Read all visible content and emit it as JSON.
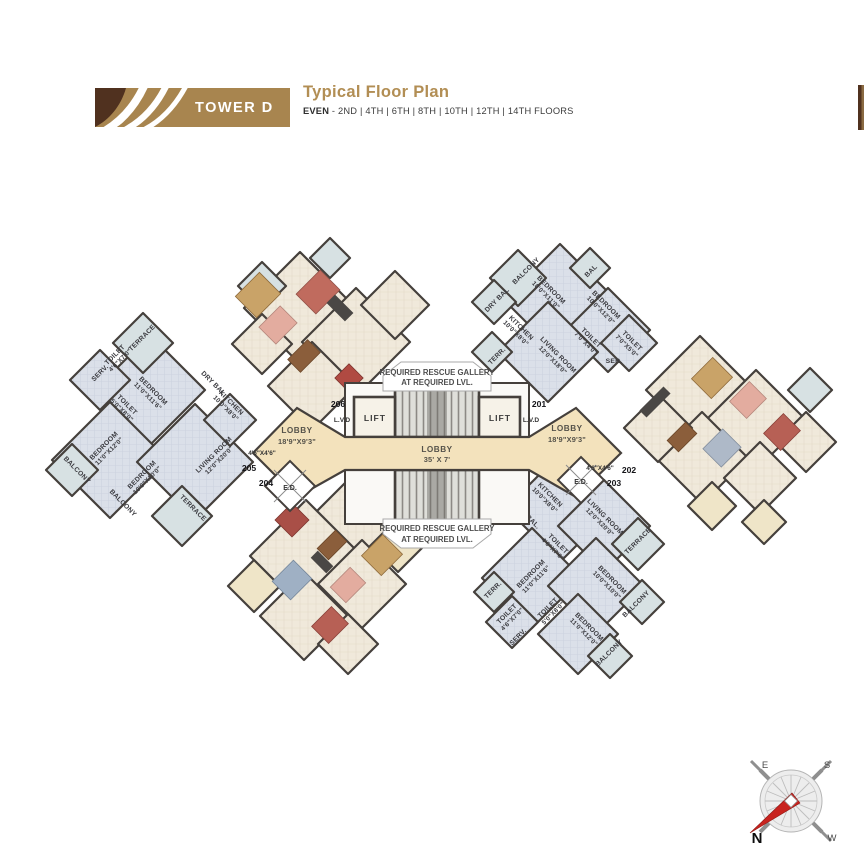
{
  "header": {
    "tower_label": "TOWER D",
    "title": "Typical Floor Plan",
    "floors_prefix": "EVEN",
    "floors_rest": " - 2ND | 4TH | 6TH | 8TH | 10TH | 12TH | 14TH FLOORS",
    "banner_color": "#A8854F",
    "banner_dark": "#50311F",
    "accent_color": "#B28E54"
  },
  "core": {
    "rescue_top_1": "REQUIRED RESCUE GALLERY",
    "rescue_top_2": "AT REQUIRED LVL.",
    "rescue_bottom_1": "REQUIRED RESCUE GALLERY",
    "rescue_bottom_2": "AT REQUIRED LVL.",
    "lobby_main": {
      "label": "LOBBY",
      "size": "35' X 7'"
    },
    "lobby_left": {
      "label": "LOBBY",
      "size": "18'9\"X9'3\""
    },
    "lobby_right": {
      "label": "LOBBY",
      "size": "18'9\"X9'3\""
    },
    "lift_left": "LIFT",
    "lift_right": "LIFT",
    "lvd_left": "L.V.D",
    "lvd_right": "L.V.D",
    "ed_left": {
      "label": "E.D.",
      "size": "4'6\"X4'6\""
    },
    "ed_right": {
      "label": "E.D.",
      "size": "4'6\"X4'6\""
    }
  },
  "unit_numbers": {
    "u201": "201",
    "u202": "202",
    "u203": "203",
    "u204": "204",
    "u205": "205",
    "u206": "206"
  },
  "unit_205": {
    "terrace_top": {
      "label": "TERRACE"
    },
    "toilet_a": {
      "label": "TOILET",
      "size": "4'6\"X7'0\""
    },
    "serv": {
      "label": "SERV."
    },
    "bedroom_a": {
      "label": "BEDROOM",
      "size": "11'0\"X11'6\""
    },
    "toilet_b": {
      "label": "TOILET",
      "size": "5'0\"X8'0\""
    },
    "dry_bal": {
      "label": "DRY BAL."
    },
    "kitchen": {
      "label": "KITCHEN",
      "size": "10'0\"X8'0\""
    },
    "bedroom_b": {
      "label": "BEDROOM",
      "size": "11'0\"X12'0\""
    },
    "balcony_a": {
      "label": "BALCONY"
    },
    "bedroom_c": {
      "label": "BEDROOM",
      "size": "10'0\"X10'0\""
    },
    "balcony_b": {
      "label": "BALCONY"
    },
    "living": {
      "label": "LIVING ROOM",
      "size": "12'0\"X20'0\""
    },
    "terrace_bottom": {
      "label": "TERRACE"
    }
  },
  "unit_201": {
    "dry_bal": {
      "label": "DRY BAL"
    },
    "balcony": {
      "label": "BALCONY"
    },
    "bedroom_a": {
      "label": "BEDROOM",
      "size": "10'0\"X11'0\""
    },
    "bal": {
      "label": "BAL"
    },
    "bedroom_b": {
      "label": "BEDROOM",
      "size": "10'0\"X12'0\""
    },
    "kitchen": {
      "label": "KITCHEN",
      "size": "10'0\"X8'0\""
    },
    "toilet_a": {
      "label": "TOILET",
      "size": "7'0\"X4'0\""
    },
    "toilet_b": {
      "label": "TOILET",
      "size": "7'0\"X5'0\""
    },
    "ser": {
      "label": "SER."
    },
    "terr": {
      "label": "TERR."
    },
    "living": {
      "label": "LIVING ROOM",
      "size": "12'0\"X18'0\""
    }
  },
  "unit_203": {
    "kitchen": {
      "label": "KITCHEN",
      "size": "10'0\"X8'0\""
    },
    "dry_bal": {
      "label": "DRY BAL."
    },
    "toilet_c": {
      "label": "TOILET",
      "size": "4'0\"X7'0\""
    },
    "living": {
      "label": "LIVING ROOM",
      "size": "12'0\"X20'0\""
    },
    "terrace": {
      "label": "TERRACE"
    },
    "bedroom_a": {
      "label": "BEDROOM",
      "size": "11'0\"X11'6\""
    },
    "terr": {
      "label": "TERR."
    },
    "toilet_a": {
      "label": "TOILET",
      "size": "4'6\"X7'0\""
    },
    "serv": {
      "label": "SERV."
    },
    "toilet_b": {
      "label": "TOILET",
      "size": "5'0\"X8'0\""
    },
    "bedroom_b": {
      "label": "BEDROOM",
      "size": "10'0\"X10'0\""
    },
    "balcony_a": {
      "label": "BALCONY"
    },
    "bedroom_c": {
      "label": "BEDROOM",
      "size": "11'0\"X12'0\""
    },
    "balcony_b": {
      "label": "BALCONY"
    }
  },
  "compass": {
    "n": "N",
    "e": "E",
    "s": "S",
    "w": "W"
  }
}
